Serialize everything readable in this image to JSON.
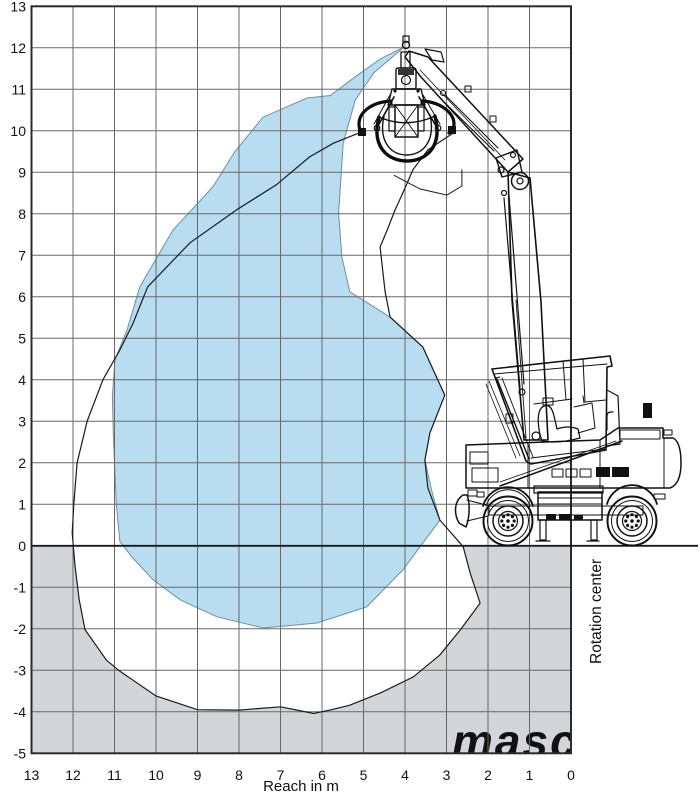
{
  "axes": {
    "x": {
      "label": "Reach in m",
      "ticks": [
        13,
        12,
        11,
        10,
        9,
        8,
        7,
        6,
        5,
        4,
        3,
        2,
        1,
        0
      ]
    },
    "y": {
      "ticks": [
        13,
        12,
        11,
        10,
        9,
        8,
        7,
        6,
        5,
        4,
        3,
        2,
        1,
        0,
        -1,
        -2,
        -3,
        -4,
        -5
      ]
    }
  },
  "annotations": {
    "rotation_center": "Rotation center",
    "watermark": "masc"
  },
  "colors": {
    "blue_fill": "#b8dcf0",
    "blue_edge": "#6b90a6",
    "ground_gray": "#d3d6d8",
    "grid": "#686868",
    "border": "#2b2b2b",
    "curve": "#1a1a1a",
    "watermark_fill": "rgba(255,255,255,0.55)"
  },
  "chart_data": {
    "type": "area",
    "title": "Working range diagram of a wheeled material handler with orange-peel grab",
    "xlabel": "Reach in m",
    "ylabel": "",
    "xlim": [
      13,
      0
    ],
    "x_axis_reversed": true,
    "ylim": [
      -5,
      13
    ],
    "grid": true,
    "ground_level_y": 0,
    "max_reach_m": 12.0,
    "max_height_m": 12.05,
    "max_depth_m": -4.05,
    "series": [
      {
        "name": "outer_working_envelope_outline",
        "unit": "m",
        "points": [
          [
            5.0,
            9.99
          ],
          [
            5.73,
            9.7
          ],
          [
            6.3,
            9.37
          ],
          [
            7.1,
            8.7
          ],
          [
            8.05,
            8.1
          ],
          [
            9.18,
            7.3
          ],
          [
            10.2,
            6.24
          ],
          [
            10.55,
            5.37
          ],
          [
            10.87,
            4.72
          ],
          [
            11.28,
            4.0
          ],
          [
            11.66,
            3.0
          ],
          [
            11.9,
            2.0
          ],
          [
            11.98,
            1.0
          ],
          [
            12.02,
            0.3
          ],
          [
            11.95,
            -0.5
          ],
          [
            11.85,
            -1.3
          ],
          [
            11.71,
            -2.02
          ],
          [
            11.2,
            -2.75
          ],
          [
            10.9,
            -3.0
          ],
          [
            10.0,
            -3.62
          ],
          [
            9.0,
            -3.95
          ],
          [
            8.0,
            -3.96
          ],
          [
            7.0,
            -3.88
          ],
          [
            6.6,
            -3.96
          ],
          [
            6.2,
            -4.04
          ],
          [
            5.81,
            -3.96
          ],
          [
            5.33,
            -3.84
          ],
          [
            4.6,
            -3.55
          ],
          [
            3.8,
            -3.16
          ],
          [
            3.16,
            -2.63
          ],
          [
            2.67,
            -2.03
          ],
          [
            2.19,
            -1.38
          ],
          [
            2.43,
            -0.66
          ],
          [
            2.6,
            -0.02
          ],
          [
            3.16,
            0.62
          ],
          [
            3.45,
            1.4
          ],
          [
            3.52,
            2.07
          ],
          [
            3.4,
            2.72
          ],
          [
            3.04,
            3.63
          ],
          [
            3.57,
            4.79
          ],
          [
            4.36,
            5.51
          ],
          [
            4.48,
            6.12
          ],
          [
            4.6,
            7.2
          ],
          [
            4.43,
            7.61
          ],
          [
            4.24,
            8.09
          ],
          [
            4.0,
            8.62
          ],
          [
            3.81,
            9.06
          ],
          [
            3.45,
            9.54
          ],
          [
            2.8,
            9.97
          ]
        ]
      },
      {
        "name": "envelope_closure_behind_grab",
        "unit": "m",
        "points": [
          [
            3.1,
            10.8
          ],
          [
            3.6,
            11.55
          ],
          [
            4.02,
            12.05
          ],
          [
            4.5,
            11.2
          ],
          [
            4.8,
            10.6
          ]
        ]
      },
      {
        "name": "grab_working_area_blue",
        "unit": "m",
        "points": [
          [
            4.02,
            12.02
          ],
          [
            4.6,
            11.73
          ],
          [
            5.2,
            11.3
          ],
          [
            5.8,
            10.85
          ],
          [
            6.36,
            10.79
          ],
          [
            7.42,
            10.33
          ],
          [
            8.1,
            9.5
          ],
          [
            8.63,
            8.65
          ],
          [
            9.59,
            7.61
          ],
          [
            10.39,
            6.24
          ],
          [
            10.7,
            5.2
          ],
          [
            10.99,
            4.48
          ],
          [
            11.05,
            3.6
          ],
          [
            11.03,
            2.7
          ],
          [
            10.96,
            1.03
          ],
          [
            10.92,
            0.62
          ],
          [
            10.87,
            0.1
          ],
          [
            10.58,
            -0.27
          ],
          [
            10.07,
            -0.82
          ],
          [
            9.42,
            -1.3
          ],
          [
            8.53,
            -1.71
          ],
          [
            7.42,
            -1.98
          ],
          [
            6.12,
            -1.86
          ],
          [
            4.92,
            -1.47
          ],
          [
            4.05,
            -0.58
          ],
          [
            3.16,
            0.62
          ],
          [
            3.35,
            1.3
          ],
          [
            3.52,
            2.07
          ],
          [
            3.4,
            2.72
          ],
          [
            3.04,
            3.63
          ],
          [
            3.57,
            4.79
          ],
          [
            4.36,
            5.51
          ],
          [
            5.33,
            6.12
          ],
          [
            5.52,
            6.96
          ],
          [
            5.6,
            8.02
          ],
          [
            5.49,
            9.7
          ],
          [
            5.2,
            10.74
          ],
          [
            4.75,
            11.4
          ]
        ]
      },
      {
        "name": "inner_curve_detail_under_grab",
        "unit": "m",
        "points": [
          [
            4.27,
            8.93
          ],
          [
            3.64,
            8.6
          ],
          [
            2.99,
            8.45
          ],
          [
            2.63,
            8.67
          ],
          [
            2.63,
            9.07
          ]
        ]
      }
    ]
  }
}
